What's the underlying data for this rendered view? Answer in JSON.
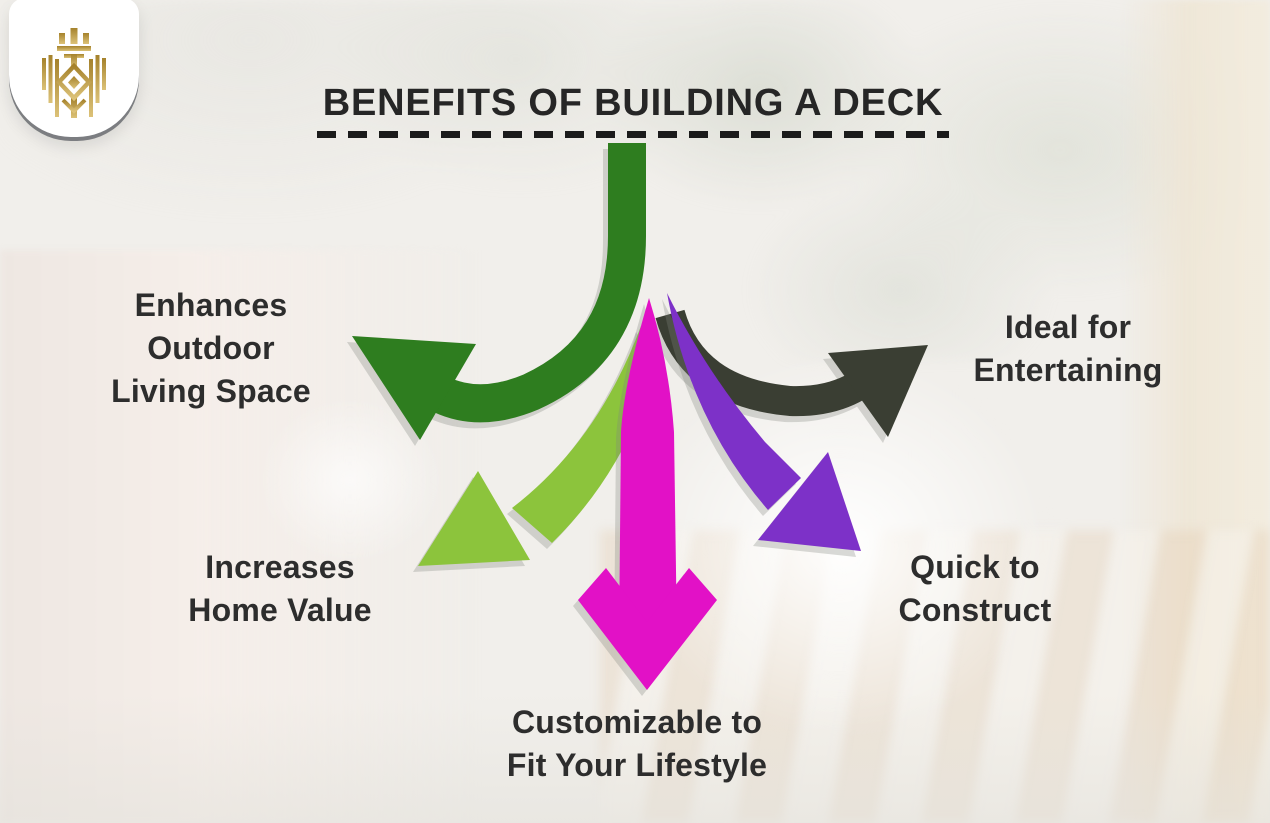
{
  "header": {
    "title": "BENEFITS OF BUILDING A DECK"
  },
  "logo": {
    "name": "gold crest emblem",
    "gold_dark": "#a5822c",
    "gold_light": "#dcc278"
  },
  "benefits": [
    {
      "label": "Enhances\nOutdoor\nLiving Space",
      "arrow_color": "#2e7d1f",
      "position": "left"
    },
    {
      "label": "Ideal for\nEntertaining",
      "arrow_color": "#3a3e33",
      "position": "right"
    },
    {
      "label": "Increases\nHome Value",
      "arrow_color": "#8cc43c",
      "position": "bottom-left"
    },
    {
      "label": "Quick to\nConstruct",
      "arrow_color": "#7d31c8",
      "position": "bottom-right"
    },
    {
      "label": "Customizable to\nFit Your Lifestyle",
      "arrow_color": "#e211c6",
      "position": "bottom-center"
    }
  ],
  "style": {
    "text_color": "#2d2d2d",
    "dash_color": "#1b1b1b",
    "background": "#f1efeb"
  }
}
